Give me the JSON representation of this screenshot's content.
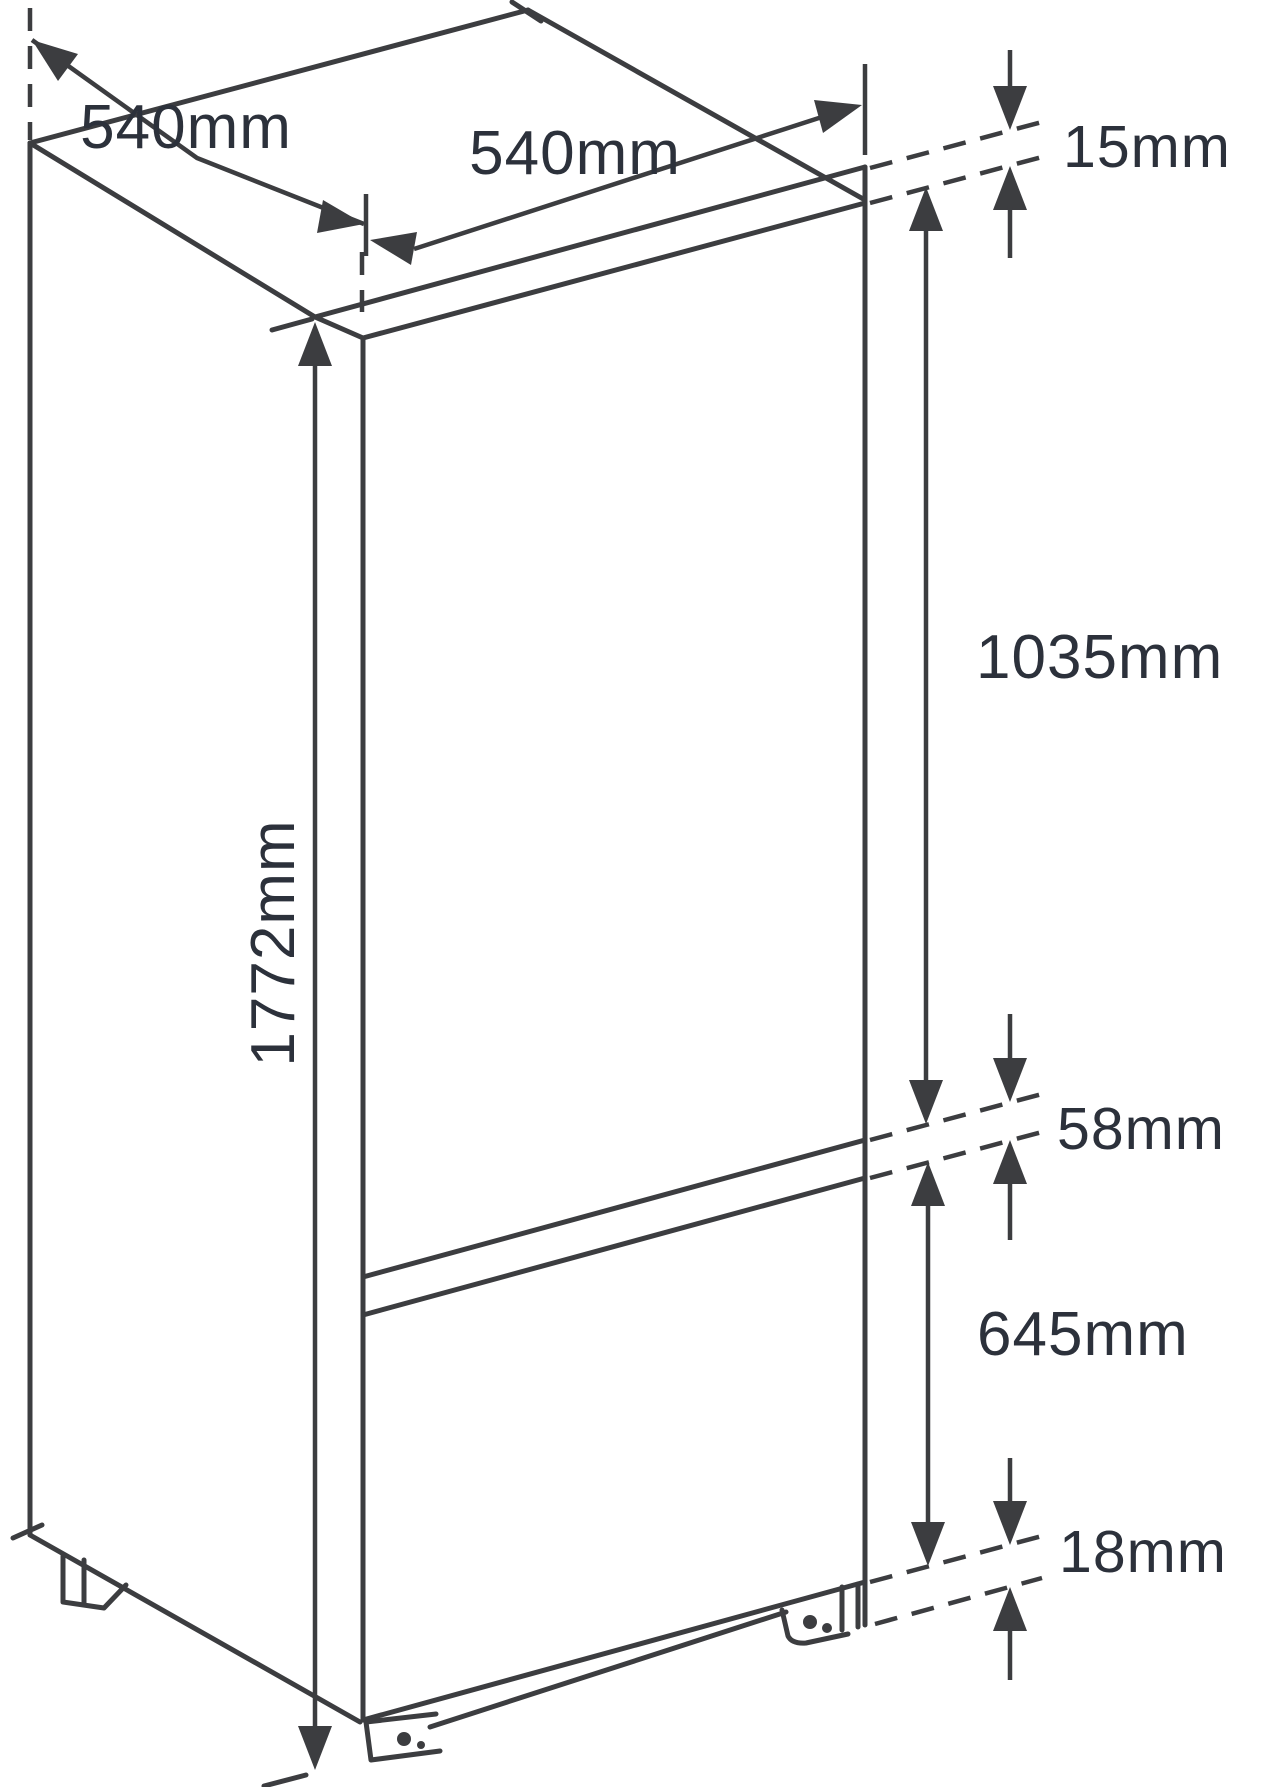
{
  "diagram": {
    "background_color": "#ffffff",
    "line_color": "#3c3d40",
    "label_color": "#2c313b",
    "unit": "mm"
  },
  "dimensions": {
    "depth_top": "540mm",
    "width_top": "540mm",
    "top_recess": "15mm",
    "upper_door_height": "1035mm",
    "door_gap": "58mm",
    "lower_door_height": "645mm",
    "bottom_recess": "18mm",
    "overall_height": "1772mm"
  }
}
